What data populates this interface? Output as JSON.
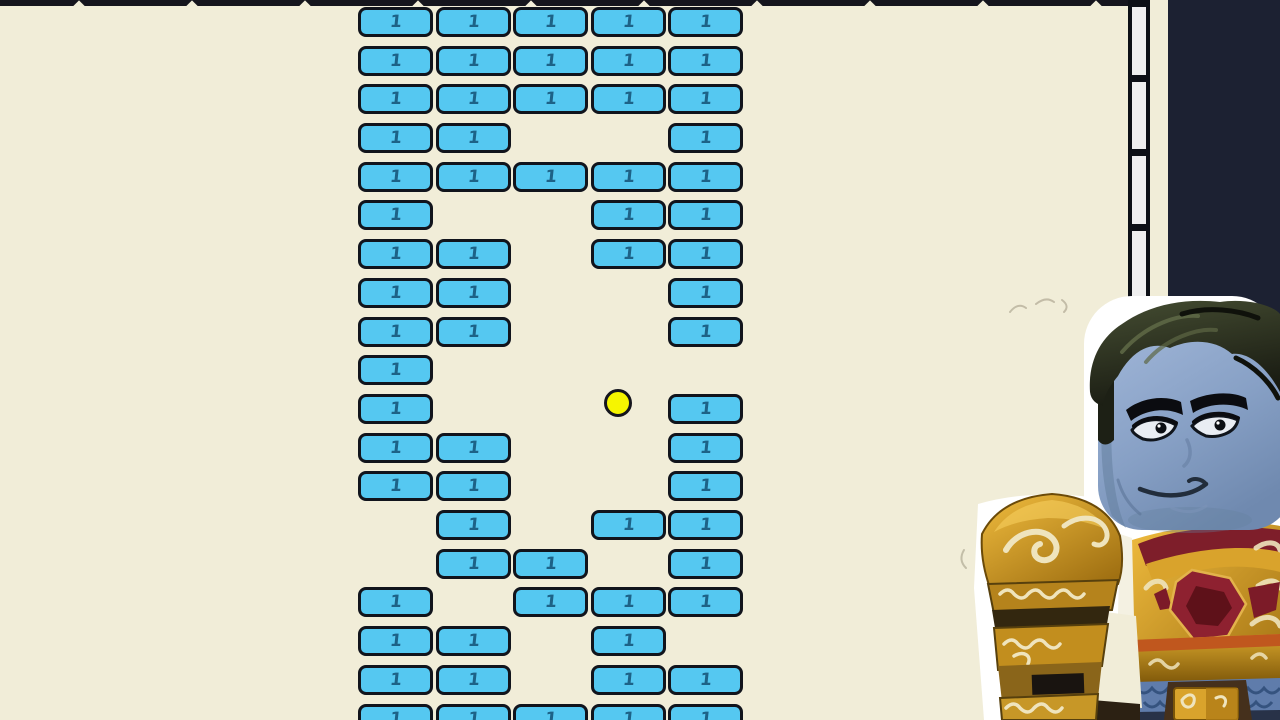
{
  "playfield": {
    "background_color": "#f1edd8",
    "wall_color": "#15151d",
    "top_wall": {
      "width": 1128,
      "height": 6,
      "notch_xs": [
        75,
        188,
        301,
        414,
        527,
        640,
        753,
        866,
        979,
        1092
      ]
    },
    "bricks": {
      "label": "1",
      "fill": "#55c8f1",
      "border": "#11141c",
      "digit_color": "#1d6287",
      "columns_x": [
        358,
        436,
        513,
        591,
        668
      ],
      "rows_y": [
        7,
        46,
        84,
        123,
        162,
        200,
        239,
        278,
        317,
        355,
        394,
        433,
        471,
        510,
        549,
        587,
        626,
        665,
        704
      ],
      "width": 75,
      "height": 30,
      "count": 67,
      "pattern": [
        [
          1,
          1,
          1,
          1,
          1
        ],
        [
          1,
          1,
          1,
          1,
          1
        ],
        [
          1,
          1,
          1,
          1,
          1
        ],
        [
          1,
          1,
          0,
          0,
          1
        ],
        [
          1,
          1,
          1,
          1,
          1
        ],
        [
          1,
          0,
          0,
          1,
          1
        ],
        [
          1,
          1,
          0,
          1,
          1
        ],
        [
          1,
          1,
          0,
          0,
          1
        ],
        [
          1,
          1,
          0,
          0,
          1
        ],
        [
          1,
          0,
          0,
          0,
          0
        ],
        [
          1,
          0,
          0,
          0,
          1
        ],
        [
          1,
          1,
          0,
          0,
          1
        ],
        [
          1,
          1,
          0,
          0,
          1
        ],
        [
          0,
          1,
          0,
          1,
          1
        ],
        [
          0,
          1,
          1,
          0,
          1
        ],
        [
          1,
          0,
          1,
          1,
          1
        ],
        [
          1,
          1,
          0,
          1,
          0
        ],
        [
          1,
          1,
          0,
          1,
          1
        ],
        [
          1,
          1,
          1,
          1,
          1
        ]
      ]
    },
    "ball": {
      "cx": 618,
      "cy": 403,
      "r": 14,
      "fill": "#f6f500"
    },
    "right_wall": {
      "x": 1128,
      "width": 22,
      "height": 380,
      "segments": 5,
      "segment_fill": "#efefef",
      "frame_color": "#0d1016"
    }
  },
  "side_panel": {
    "x": 1168,
    "width": 112,
    "color": "#1c2132"
  },
  "character": {
    "name": "roblox-knight-avatar",
    "colors": {
      "face": "#8aa2c6",
      "hair": "#20241a",
      "outline": "#ffffff",
      "armor_gold": "#cf9a26",
      "emblem_red": "#8e2130",
      "swirl_cream": "#efe4bd",
      "chainmail_blue": "#5f7cab"
    }
  }
}
